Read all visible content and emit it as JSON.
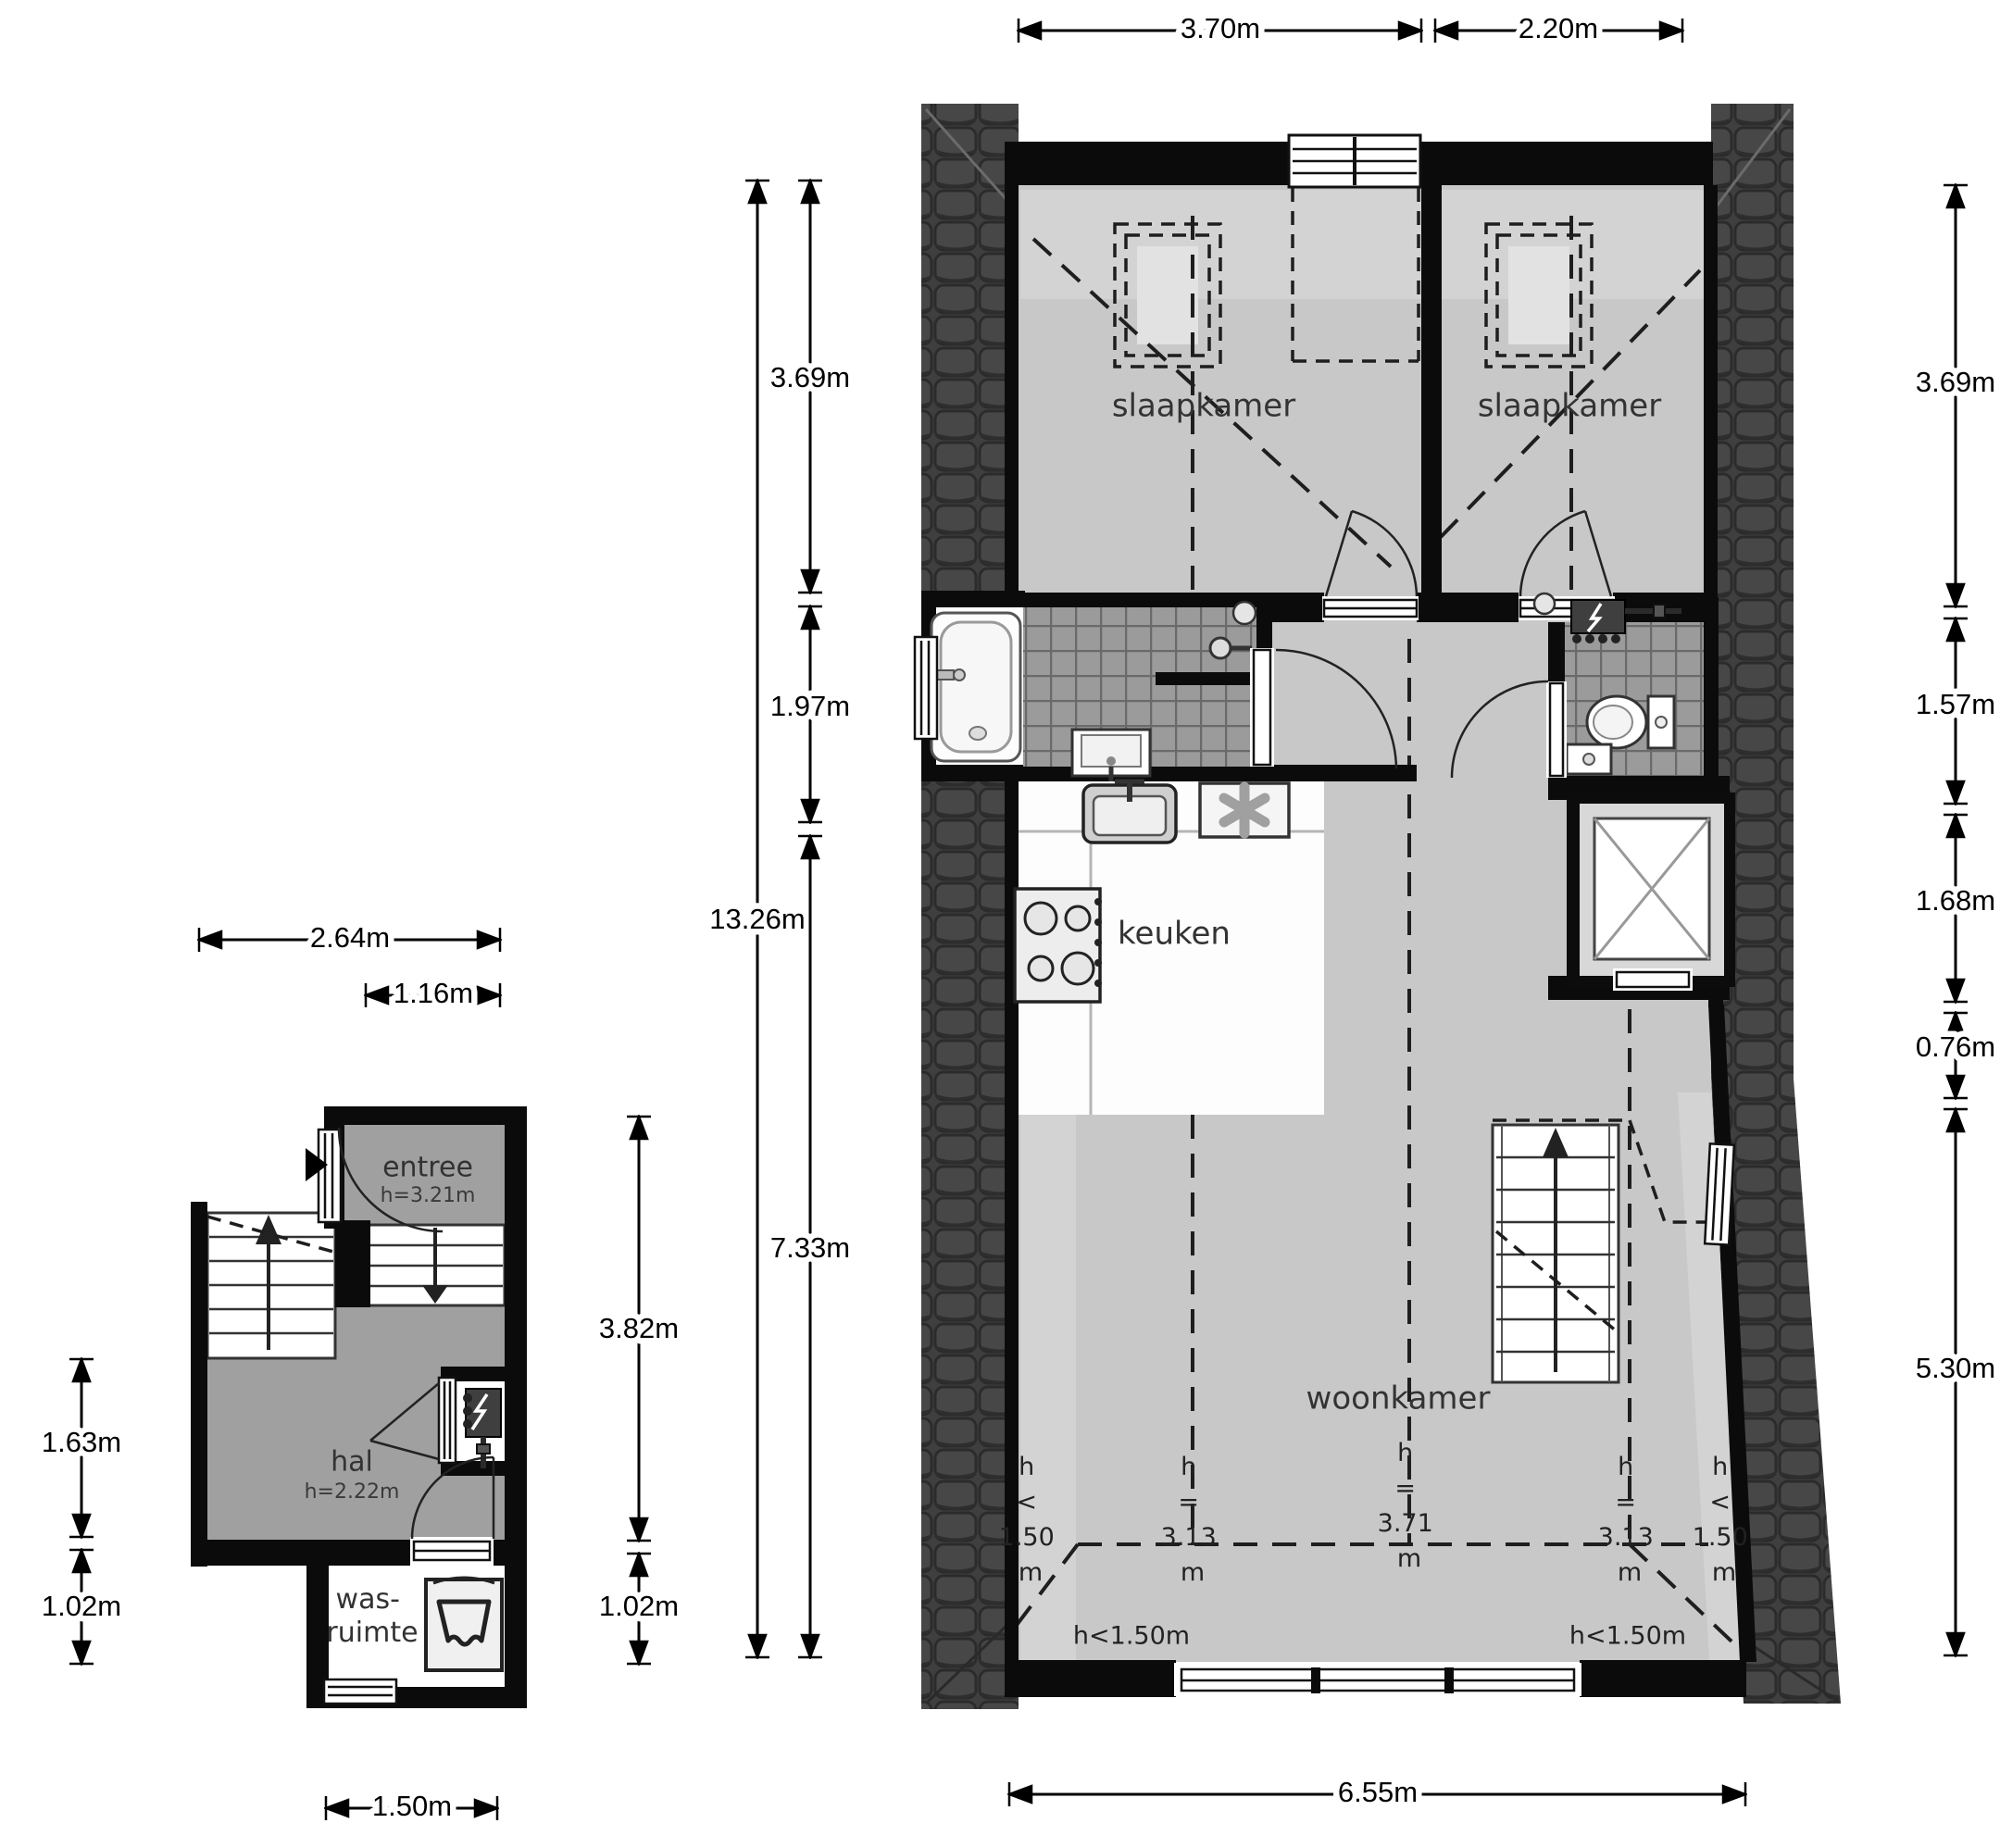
{
  "upper_floor": {
    "rooms": {
      "bedroom_left": "slaapkamer",
      "bedroom_right": "slaapkamer",
      "kitchen": "keuken",
      "living": "woonkamer"
    },
    "dims": {
      "top": [
        "3.70m",
        "2.20m"
      ],
      "left_total": "13.26m",
      "left_segments": [
        "3.69m",
        "1.97m",
        "7.33m"
      ],
      "right_segments": [
        "3.69m",
        "1.57m",
        "1.68m",
        "0.76m",
        "5.30m"
      ],
      "bottom": "6.55m"
    },
    "h_marks": [
      {
        "lines": [
          "h",
          "<",
          "1.50",
          "m"
        ]
      },
      {
        "lines": [
          "h",
          "=",
          "3.13",
          "m"
        ]
      },
      {
        "lines": [
          "h",
          "=",
          "3.71",
          "m"
        ]
      },
      {
        "lines": [
          "h",
          "=",
          "3.13",
          "m"
        ]
      },
      {
        "lines": [
          "h",
          "<",
          "1.50",
          "m"
        ]
      }
    ],
    "h_corners": [
      "h<1.50m",
      "h<1.50m"
    ]
  },
  "ground_floor": {
    "rooms": {
      "entree": {
        "label": "entree",
        "height": "h=3.21m"
      },
      "hal": {
        "label": "hal",
        "height": "h=2.22m"
      },
      "laundry": {
        "line1": "was-",
        "line2": "ruimte"
      }
    },
    "dims": {
      "top": [
        "2.64m",
        "1.16m"
      ],
      "left": [
        "1.63m",
        "1.02m"
      ],
      "right": [
        "3.82m",
        "1.02m"
      ],
      "bottom": "1.50m"
    }
  },
  "colors": {
    "wall": "#0b0b0b",
    "floor_upper": "#c8c8c8",
    "floor_upper_light": "#d3d3d3",
    "floor_ground": "#a0a0a0",
    "roof": "#3f3f3f",
    "bath_tile": "#9b9b9b",
    "dimension": "#000000"
  }
}
